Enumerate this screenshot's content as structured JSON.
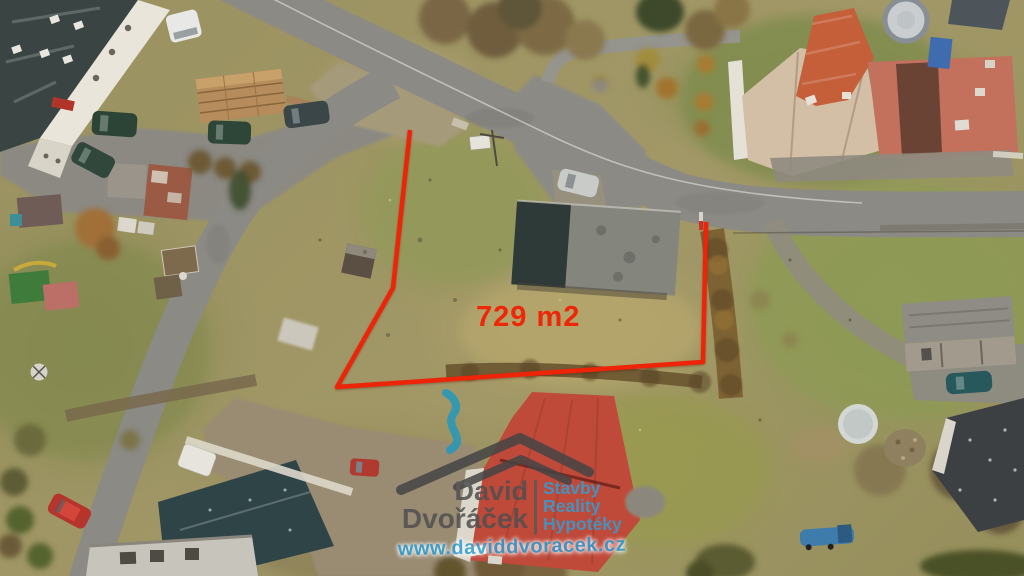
{
  "annotation": {
    "area_label": "729 m2",
    "area_label_color": "#ee2708",
    "boundary_color": "#ee2408",
    "boundary_points": "410,130 393,288 337,387 703,362 706,222"
  },
  "watermark": {
    "name_line1": "David",
    "name_line2": "Dvořáček",
    "services_line1": "Stavby",
    "services_line2": "Reality",
    "services_line3": "Hypotéky",
    "website": "www.daviddvoracek.cz",
    "name_color": "#4f4f4f",
    "accent_color": "#2f9fd4",
    "smoke_color": "#2498bd",
    "icons": [
      "house-roof-icon",
      "chimney-smoke-icon"
    ]
  }
}
